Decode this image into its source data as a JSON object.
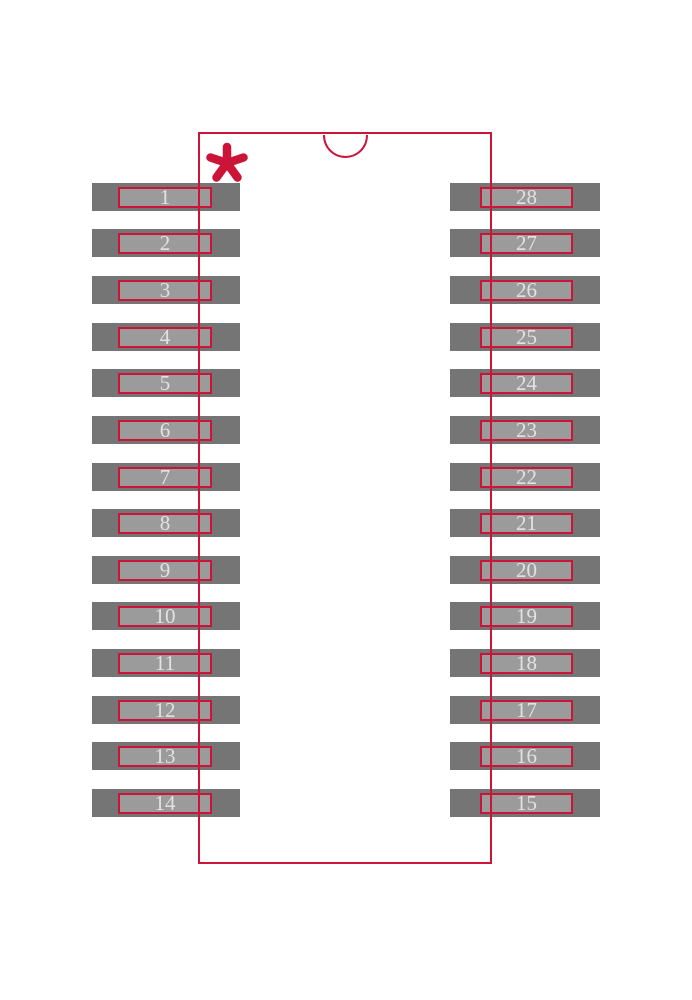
{
  "diagram": {
    "kind": "ic-package-footprint",
    "pin_count": 28,
    "pin1_marker_glyph": "*",
    "notch_shape": "top-center-semicircle"
  },
  "colors": {
    "outline_red": "#cc1439",
    "pad_outer_gray": "#757575",
    "pad_inner_gray": "#9b9b9b",
    "pin_number_text": "#e2e2e2",
    "background": "#ffffff"
  },
  "pins": {
    "left": [
      "1",
      "2",
      "3",
      "4",
      "5",
      "6",
      "7",
      "8",
      "9",
      "10",
      "11",
      "12",
      "13",
      "14"
    ],
    "right": [
      "28",
      "27",
      "26",
      "25",
      "24",
      "23",
      "22",
      "21",
      "20",
      "19",
      "18",
      "17",
      "16",
      "15"
    ]
  }
}
